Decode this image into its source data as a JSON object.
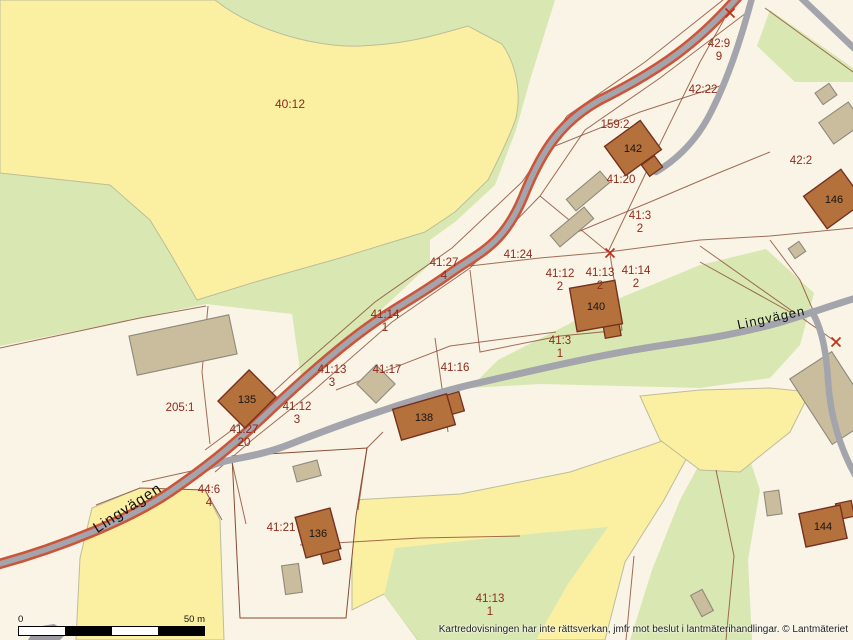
{
  "colors": {
    "cream": "#f9f4e5",
    "yellow": "#fbf0a2",
    "green": "#d9e8b2",
    "gray": "#9a9aa0",
    "road_gray": "#a4a4ac",
    "road_casing": "#cc5438",
    "boundary": "#8a4a35",
    "land_line": "#bdbd9a",
    "building_fill": "#b5713c",
    "building_stroke": "#76301f",
    "outbuilding_fill": "#cabd9e",
    "outbuilding_stroke": "#8e897b",
    "parcel_label": "#8e2b1d",
    "black_text": "#151515",
    "survey_mark": "#c03018"
  },
  "map": {
    "regions": [
      {
        "fill": "green",
        "d": "M215,0 L555,0 L530,80 L516,130 L495,185 L455,222 L430,240 L430,264 L302,384 L292,314 L206,304 L140,318 L0,346 L0,0 Z"
      },
      {
        "fill": "green",
        "d": "M770,10 L853,68 L853,82 L795,82 L757,46 Z"
      },
      {
        "fill": "green",
        "d": "M498,360 L620,298 L700,265 L766,249 L814,293 L800,345 L770,378 L700,388 L620,386 L540,384 L470,388 Z"
      },
      {
        "fill": "green",
        "d": "M630,640 L652,570 L680,500 L706,452 L745,445 L760,490 L748,560 L752,640 Z"
      },
      {
        "fill": "yellow",
        "line": "land_line",
        "d": "M0,0 L215,0 C255,32 320,48 360,46 C410,44 440,34 468,26 L502,44 C520,70 520,100 516,118 C510,136 498,160 488,180 L455,212 L425,232 L340,258 L255,282 L197,300 L170,253 L150,220 L110,185 L0,173 Z"
      },
      {
        "fill": "yellow",
        "line": "land_line",
        "d": "M76,640 L80,558 L92,508 L140,488 L205,490 L220,520 L224,640 Z"
      },
      {
        "fill": "yellow",
        "line": "land_line",
        "d": "M352,500 L460,494 L570,472 L648,446 L704,426 L664,500 L625,562 L605,640 L418,640 L384,594 L352,610 Z"
      },
      {
        "fill": "yellow",
        "line": "land_line",
        "d": "M640,396 L700,390 L770,388 L810,392 L790,432 L740,472 L700,470 L660,440 Z"
      },
      {
        "fill": "green",
        "d": "M395,548 L540,533 L608,527 L568,584 L536,640 L418,640 L384,595 Z"
      },
      {
        "fill": "cream",
        "line": "boundary",
        "d": "M232,456 L367,448 L356,516 L346,618 L240,618 Z"
      },
      {
        "fill": "gray",
        "d": "M28,640 L36,627 L54,624 L68,632 L60,640 Z"
      }
    ],
    "boundary_lines": [
      "M750,10 L660,78 L585,130 L540,196 L470,268 L392,322 L312,392 L252,440 L215,472",
      "M728,-4 L645,62 L567,116 L522,182 L452,248 L375,302 L295,372 L232,430 L205,450",
      "M452,268 L540,258 L608,252 L700,240 L770,236 L853,228",
      "M608,252 L652,160 L700,62 L726,16",
      "M540,196 L608,252",
      "M545,150 L640,112 L726,84",
      "M558,240 L650,202 L716,174 L770,152",
      "M470,270 L480,352 L560,336 L622,330 L610,254",
      "M336,390 L450,346 L556,332",
      "M435,338 L448,432",
      "M142,482 L232,462 L246,524",
      "M208,306 L202,372 L210,444",
      "M0,348 L140,318 L206,306",
      "M716,470 L734,556 L726,640",
      "M634,556 L626,640",
      "M700,246 L836,342",
      "M700,262 L790,312",
      "M765,8 L853,72",
      "M770,240 L800,280 L812,308",
      "M818,320 L828,372 L834,430",
      "M358,510 L367,448 L383,432",
      "M300,545 L420,538 L520,536",
      "M96,505 L140,488 L205,490 L222,520"
    ],
    "roads": {
      "main": {
        "id": "main-road",
        "d": "M742,-8 C700,42 660,70 600,100 C560,122 542,152 526,190 C505,245 480,252 452,272 C420,295 400,305 375,322 C340,346 300,382 262,418 C230,448 205,468 170,492 C130,519 60,548 -8,566",
        "casing_w": 10.5,
        "w": 5.5
      },
      "secondary": [
        {
          "id": "lingvagen-east",
          "d": "M856,298 C830,306 808,314 778,323 C738,334 706,339 658,346 C600,355 548,367 478,383 C420,396 338,425 288,445 C252,459 224,458 206,468",
          "w": 7,
          "cap": "butt"
        },
        {
          "id": "branch-south",
          "d": "M810,309 C820,323 826,346 828,380 C830,415 840,450 858,480",
          "w": 6.5,
          "cap": "butt"
        },
        {
          "id": "stub-north",
          "d": "M753,-6 C742,36 728,78 713,108 C698,140 676,160 656,172",
          "w": 6.5,
          "cap": "round"
        },
        {
          "id": "corner-north-east",
          "d": "M797,-6 L858,52",
          "w": 6.5,
          "cap": "butt"
        }
      ]
    },
    "outbuildings": [
      {
        "cx": 183,
        "cy": 345,
        "w": 102,
        "h": 40,
        "rot": -12
      },
      {
        "cx": 376,
        "cy": 384,
        "w": 27,
        "h": 27,
        "rot": -45
      },
      {
        "cx": 588,
        "cy": 191,
        "w": 44,
        "h": 15,
        "rot": -40
      },
      {
        "cx": 572,
        "cy": 227,
        "w": 44,
        "h": 15,
        "rot": -40
      },
      {
        "cx": 826,
        "cy": 94,
        "w": 17,
        "h": 14,
        "rot": -35
      },
      {
        "cx": 841,
        "cy": 123,
        "w": 36,
        "h": 26,
        "rot": -35
      },
      {
        "cx": 797,
        "cy": 250,
        "w": 13,
        "h": 12,
        "rot": -35
      },
      {
        "cx": 832,
        "cy": 398,
        "w": 50,
        "h": 78,
        "rot": -33
      },
      {
        "cx": 773,
        "cy": 503,
        "w": 15,
        "h": 24,
        "rot": -8
      },
      {
        "cx": 307,
        "cy": 471,
        "w": 25,
        "h": 16,
        "rot": -15
      },
      {
        "cx": 292,
        "cy": 579,
        "w": 17,
        "h": 29,
        "rot": -8
      },
      {
        "cx": 702,
        "cy": 603,
        "w": 13,
        "h": 24,
        "rot": -28
      }
    ],
    "buildings": [
      {
        "label": "135",
        "cx": 247,
        "cy": 399,
        "w": 44,
        "h": 38,
        "rot": -45
      },
      {
        "label": "136",
        "cx": 318,
        "cy": 533,
        "w": 36,
        "h": 42,
        "rot": -15
      },
      {
        "label": "138",
        "cx": 424,
        "cy": 417,
        "w": 56,
        "h": 32,
        "rot": -16
      },
      {
        "label": "140",
        "cx": 596,
        "cy": 306,
        "w": 46,
        "h": 44,
        "rot": -10
      },
      {
        "label": "142",
        "cx": 633,
        "cy": 148,
        "w": 44,
        "h": 36,
        "rot": -36
      },
      {
        "label": "144",
        "cx": 823,
        "cy": 526,
        "w": 42,
        "h": 34,
        "rot": -12
      },
      {
        "label": "146",
        "cx": 834,
        "cy": 199,
        "w": 46,
        "h": 40,
        "rot": -36
      }
    ],
    "annexes": [
      {
        "cx": 452,
        "cy": 404,
        "w": 20,
        "h": 20,
        "rot": -16
      },
      {
        "cx": 330,
        "cy": 554,
        "w": 18,
        "h": 16,
        "rot": -15
      },
      {
        "cx": 845,
        "cy": 510,
        "w": 16,
        "h": 16,
        "rot": -12
      },
      {
        "cx": 612,
        "cy": 330,
        "w": 16,
        "h": 14,
        "rot": -10
      },
      {
        "cx": 652,
        "cy": 166,
        "w": 16,
        "h": 14,
        "rot": -36
      }
    ],
    "survey_marks": [
      {
        "x": 730,
        "y": 13
      },
      {
        "x": 610,
        "y": 253
      },
      {
        "x": 836,
        "y": 342
      }
    ],
    "parcel_labels": [
      {
        "lines": [
          "40:12"
        ],
        "x": 290,
        "y": 104,
        "size": 12
      },
      {
        "lines": [
          "42:9",
          "9"
        ],
        "x": 719,
        "y": 43,
        "size": 11.5
      },
      {
        "lines": [
          "42:22"
        ],
        "x": 703,
        "y": 89,
        "size": 11.5
      },
      {
        "lines": [
          "159:2"
        ],
        "x": 615,
        "y": 124,
        "size": 11.5
      },
      {
        "lines": [
          "41:20"
        ],
        "x": 621,
        "y": 179,
        "size": 11.5
      },
      {
        "lines": [
          "42:2"
        ],
        "x": 801,
        "y": 160,
        "size": 11.5
      },
      {
        "lines": [
          "41:3",
          "2"
        ],
        "x": 640,
        "y": 215,
        "size": 11.5
      },
      {
        "lines": [
          "41:24"
        ],
        "x": 518,
        "y": 254,
        "size": 11.5
      },
      {
        "lines": [
          "41:27",
          "4"
        ],
        "x": 444,
        "y": 262,
        "size": 11.5
      },
      {
        "lines": [
          "41:12",
          "2"
        ],
        "x": 560,
        "y": 273,
        "size": 11.5
      },
      {
        "lines": [
          "41:13",
          "2"
        ],
        "x": 600,
        "y": 272,
        "size": 11.5
      },
      {
        "lines": [
          "41:14",
          "2"
        ],
        "x": 636,
        "y": 270,
        "size": 11.5
      },
      {
        "lines": [
          "41:14",
          "1"
        ],
        "x": 385,
        "y": 314,
        "size": 11.5
      },
      {
        "lines": [
          "41:3",
          "1"
        ],
        "x": 560,
        "y": 340,
        "size": 11.5
      },
      {
        "lines": [
          "41:13",
          "3"
        ],
        "x": 332,
        "y": 369,
        "size": 11.5
      },
      {
        "lines": [
          "41:17"
        ],
        "x": 387,
        "y": 369,
        "size": 11.5
      },
      {
        "lines": [
          "41:16"
        ],
        "x": 455,
        "y": 367,
        "size": 11.5
      },
      {
        "lines": [
          "41:12",
          "3"
        ],
        "x": 297,
        "y": 406,
        "size": 11.5
      },
      {
        "lines": [
          "205:1"
        ],
        "x": 180,
        "y": 407,
        "size": 11.5
      },
      {
        "lines": [
          "41:27",
          "20"
        ],
        "x": 244,
        "y": 429,
        "size": 11.5
      },
      {
        "lines": [
          "44:6",
          "4"
        ],
        "x": 209,
        "y": 489,
        "size": 11.5
      },
      {
        "lines": [
          "41:21"
        ],
        "x": 281,
        "y": 527,
        "size": 11.5
      },
      {
        "lines": [
          "41:13",
          "1"
        ],
        "x": 490,
        "y": 598,
        "size": 11.5
      }
    ],
    "road_names": [
      {
        "text": "Lingvägen",
        "x": 130,
        "y": 512,
        "rot": -33,
        "size": 15
      },
      {
        "text": "Lingvägen",
        "x": 772,
        "y": 322,
        "rot": -12,
        "size": 13
      }
    ]
  },
  "scale_bar": {
    "zero_label": "0",
    "distance_label": "50 m"
  },
  "footer": {
    "disclaimer": "Kartredovisningen har inte rättsverkan, jmfr mot beslut i lantmäterihandlingar. © Lantmäteriet"
  }
}
